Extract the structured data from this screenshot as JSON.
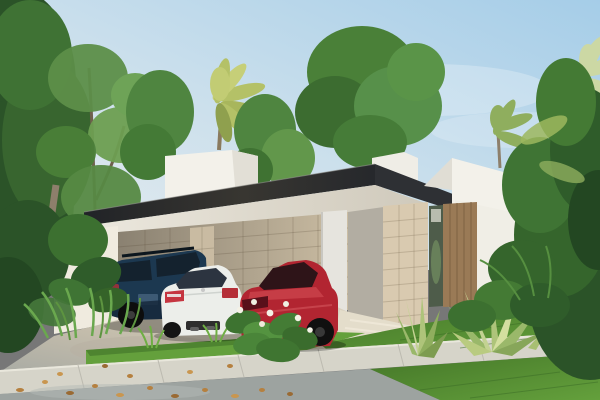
{
  "scene": {
    "type": "architectural-exterior-render",
    "description": "Modern single-storey tropical house with dark flat cantilevered roof over a carport, three parked cars, stone-clad walls, wooden entry door, lawn, sidewalk and dense palm vegetation",
    "objects": [
      "sky",
      "background-trees",
      "fan-palm",
      "right-palms",
      "house",
      "upper-white-volume",
      "roof-fascia",
      "soffit",
      "carport-back-wall",
      "stone-column",
      "white-column",
      "entry-stone-column",
      "wood-door",
      "glass-sidelight",
      "suv",
      "white-sedan",
      "red-coupe",
      "driveway",
      "entry-steps",
      "grass-strip",
      "lawn",
      "sidewalk",
      "road",
      "fallen-leaves",
      "left-plants",
      "flower-bush",
      "agave-cluster",
      "right-jungle"
    ]
  },
  "colors": {
    "sky_pale": "#e9edef",
    "sky_mid": "#cadfec",
    "sky_blue": "#a5cde8",
    "roof_dark": "#212327",
    "roof_dark2": "#383631",
    "soffit": "#ece8de",
    "wall_white": "#f3f1ea",
    "wall_white_shade": "#e2dfd6",
    "stone_lit": "#d9cab0",
    "stone_mid": "#c9bba2",
    "stone_shade": "#8a8171",
    "stone_light_end": "#cbbda3",
    "column_white": "#e6e4de",
    "recess_grey": "#b2ada2",
    "door_wood": "#9a7a56",
    "door_wood_dark": "#7d6143",
    "glass_green": "#4e5c4a",
    "driveway_lit": "#e2dac8",
    "driveway_mid": "#c3bcab",
    "road_grey": "#9da3a0",
    "path_light": "#e4ddcb",
    "sidewalk": "#d6d4c9",
    "curb_highlight": "#e9e7dc",
    "grass_light": "#64a03c",
    "grass_dark": "#447628",
    "foliage_dark": "#2b5328",
    "foliage_mid": "#4a8038",
    "foliage_light": "#6aa84e",
    "palm_yellow": "#b4c167",
    "palm_pale": "#ccd8a4",
    "agave_light": "#c3d292",
    "agave_mid": "#9ab86a",
    "trunk_brown": "#6f604d",
    "palm_trunk": "#8d7f6b",
    "suv_navy": "#1c3850",
    "suv_dark": "#14222e",
    "sedan_white": "#eceeea",
    "sedan_glass": "#2c3440",
    "coupe_red": "#b22531",
    "coupe_glass": "#2e1418",
    "taillight_red": "#c53540",
    "leaf_litter": "#b5803f",
    "leaf_litter2": "#c9964f"
  }
}
